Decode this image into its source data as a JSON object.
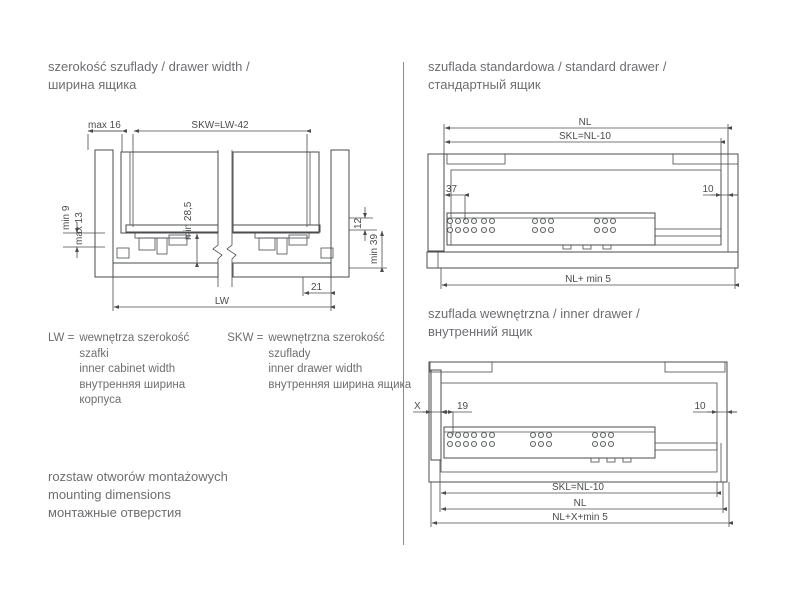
{
  "headings": {
    "drawer_width": {
      "l1": "szerokość szuflady / drawer width /",
      "l2": "ширина ящика"
    },
    "standard_drawer": {
      "l1": "szuflada standardowa / standard drawer /",
      "l2": "стандартный ящик"
    },
    "inner_drawer": {
      "l1": "szuflada wewnętrzna / inner drawer /",
      "l2": "внутренний ящик"
    }
  },
  "legend": {
    "lw": {
      "term": "LW =",
      "lines": [
        "wewnętrza szerokość",
        "szafki",
        "inner cabinet width",
        "внутренняя ширина",
        "корпуса"
      ]
    },
    "skw": {
      "term": "SKW =",
      "lines": [
        "wewnętrzna szerokość",
        "szuflady",
        "inner drawer width",
        "внутренняя ширина ящика"
      ]
    }
  },
  "mounting": {
    "l1": "rozstaw otworów montażowych",
    "l2": "mounting dimensions",
    "l3": "монтажные отверстия"
  },
  "cross_section_dims": {
    "max16": "max 16",
    "skw": "SKW=LW-42",
    "min9": "min 9",
    "max13": "max 13",
    "min285": "min 28,5",
    "d12": "12",
    "min39": "min 39",
    "d21": "21",
    "lw": "LW"
  },
  "standard_dims": {
    "nl": "NL",
    "skl": "SKL=NL-10",
    "d37": "37",
    "d10": "10",
    "nlmin5": "NL+ min 5"
  },
  "inner_dims": {
    "x": "X",
    "d19": "19",
    "d10": "10",
    "skl": "SKL=NL-10",
    "nl": "NL",
    "nlxmin5": "NL+X+min 5"
  },
  "colors": {
    "cabinet": "#aeb0b2",
    "panel": "#c4c6c8",
    "rail": "#d9dadb",
    "front": "#636567",
    "line": "#4a4c4e",
    "text": "#6d6e71"
  }
}
